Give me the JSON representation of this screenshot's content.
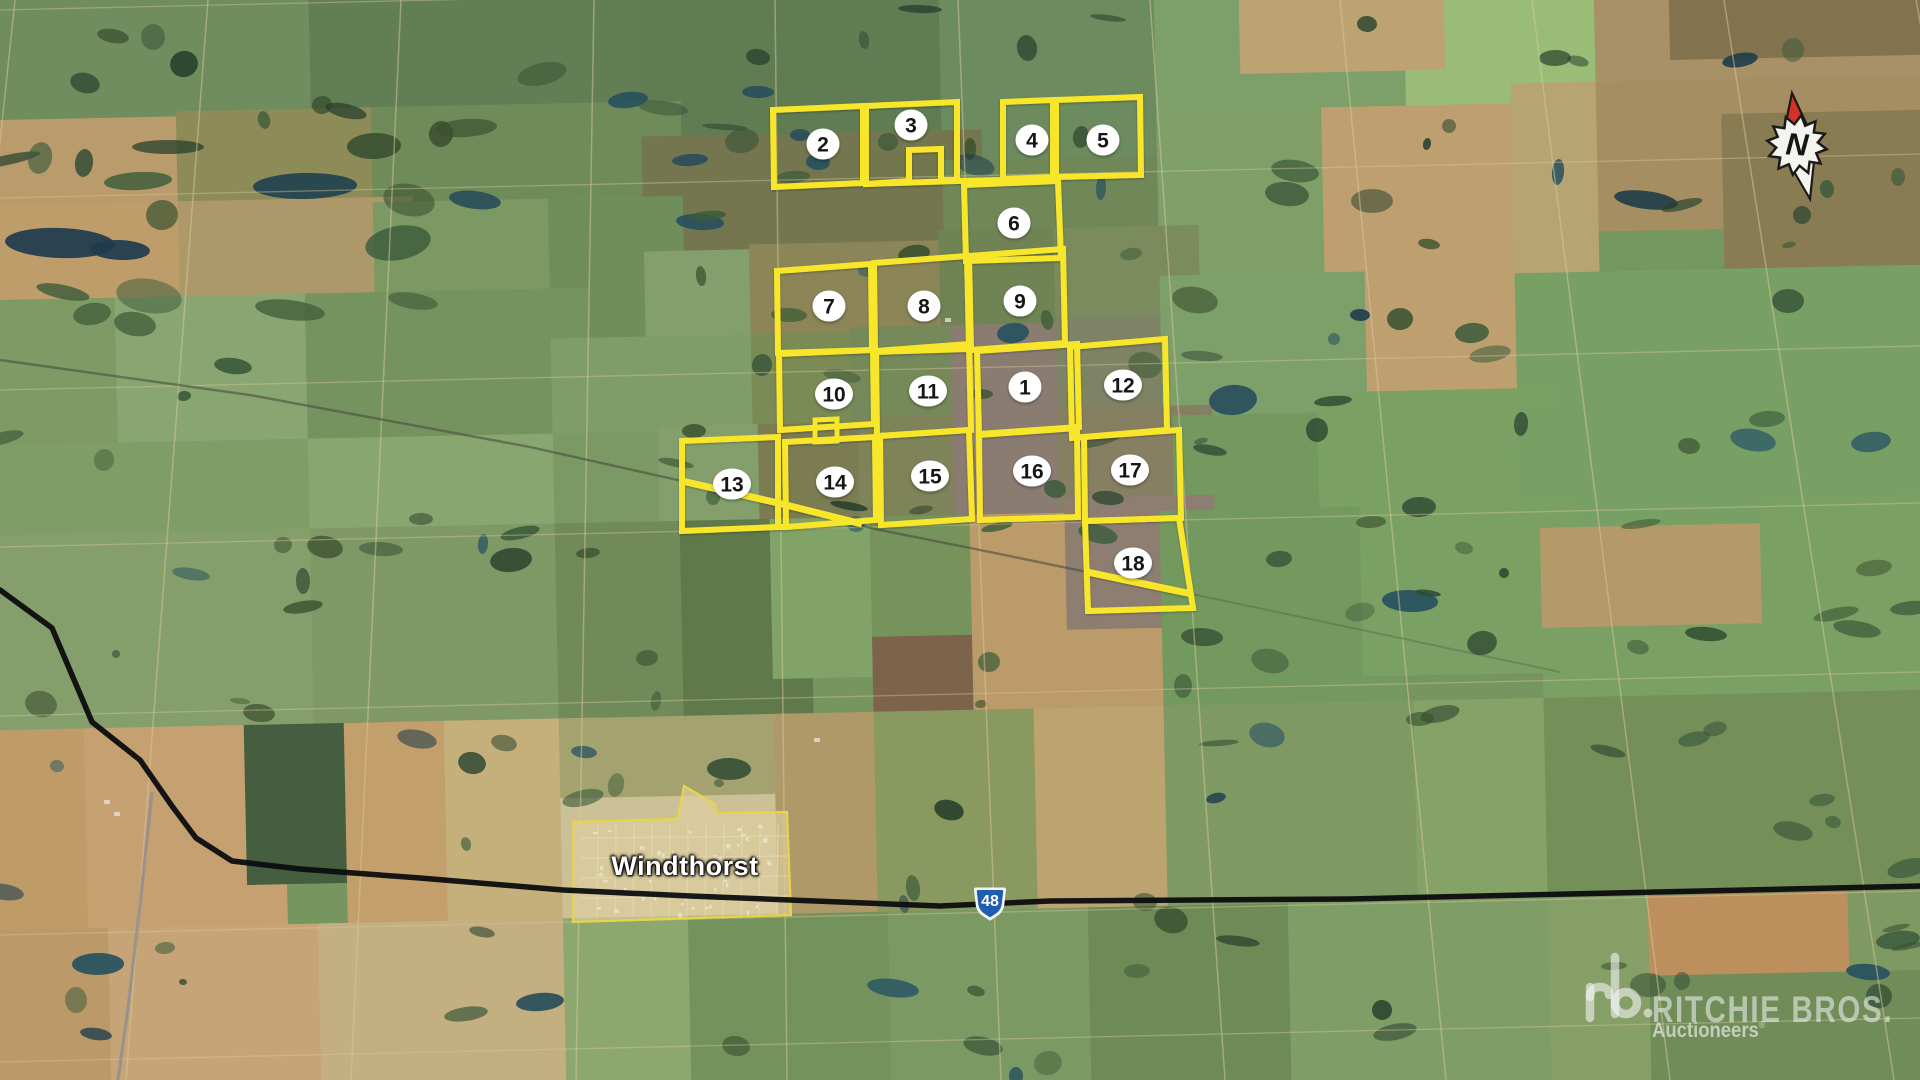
{
  "map": {
    "town": {
      "name": "Windthorst",
      "outline": [
        [
          573,
          822
        ],
        [
          678,
          819
        ],
        [
          684,
          786
        ],
        [
          715,
          804
        ],
        [
          716,
          813
        ],
        [
          787,
          812
        ],
        [
          791,
          915
        ],
        [
          573,
          922
        ]
      ]
    },
    "highway_shield": {
      "number": "48",
      "x": 990,
      "y": 905
    },
    "compass": {
      "label": "N"
    },
    "watermark": {
      "mark": "rb",
      "title": "RITCHIE BROS.",
      "tagline": "Auctioneers",
      "registered": "®"
    },
    "colors": {
      "parcel_outline": "#f8e62a",
      "marker_fill": "#ffffff",
      "marker_text": "#161616",
      "town_outline": "#e8d44c",
      "town_fill": "rgba(240,225,170,0.22)",
      "highway": "#0c0d0f",
      "shield_blue": "#1d5fae",
      "railway": "#43463a",
      "gray_road": "#8e8e8e",
      "section_road": "#dac89c"
    }
  },
  "parcels": [
    {
      "number": "1",
      "marker": [
        1025,
        387
      ],
      "outline": [
        [
          977,
          351
        ],
        [
          1077,
          344
        ],
        [
          1079,
          427
        ],
        [
          979,
          434
        ]
      ]
    },
    {
      "number": "2",
      "marker": [
        823,
        144
      ],
      "outline": [
        [
          773,
          110
        ],
        [
          863,
          106
        ],
        [
          863,
          183
        ],
        [
          774,
          187
        ]
      ]
    },
    {
      "number": "3",
      "marker": [
        911,
        125
      ],
      "outline": [
        [
          866,
          106
        ],
        [
          957,
          102
        ],
        [
          957,
          180
        ],
        [
          941,
          180
        ],
        [
          941,
          149
        ],
        [
          909,
          150
        ],
        [
          909,
          181
        ],
        [
          866,
          184
        ]
      ]
    },
    {
      "number": "4",
      "marker": [
        1032,
        140
      ],
      "outline": [
        [
          1003,
          102
        ],
        [
          1053,
          100
        ],
        [
          1053,
          177
        ],
        [
          1003,
          179
        ]
      ]
    },
    {
      "number": "5",
      "marker": [
        1103,
        140
      ],
      "outline": [
        [
          1056,
          100
        ],
        [
          1140,
          97
        ],
        [
          1141,
          175
        ],
        [
          1056,
          177
        ]
      ]
    },
    {
      "number": "6",
      "marker": [
        1014,
        223
      ],
      "outline": [
        [
          964,
          185
        ],
        [
          1058,
          181
        ],
        [
          1061,
          258
        ],
        [
          966,
          261
        ]
      ]
    },
    {
      "number": "7",
      "marker": [
        829,
        306
      ],
      "outline": [
        [
          777,
          271
        ],
        [
          871,
          264
        ],
        [
          872,
          350
        ],
        [
          778,
          353
        ]
      ]
    },
    {
      "number": "8",
      "marker": [
        924,
        306
      ],
      "outline": [
        [
          874,
          263
        ],
        [
          967,
          256
        ],
        [
          969,
          349
        ],
        [
          875,
          352
        ]
      ]
    },
    {
      "number": "9",
      "marker": [
        1020,
        301
      ],
      "outline": [
        [
          969,
          256
        ],
        [
          1063,
          249
        ],
        [
          1065,
          343
        ],
        [
          971,
          350
        ]
      ]
    },
    {
      "number": "10",
      "marker": [
        834,
        394
      ],
      "outline": [
        [
          779,
          354
        ],
        [
          873,
          350
        ],
        [
          874,
          424
        ],
        [
          780,
          430
        ]
      ]
    },
    {
      "number": "11",
      "marker": [
        928,
        391
      ],
      "outline": [
        [
          876,
          351
        ],
        [
          969,
          344
        ],
        [
          971,
          430
        ],
        [
          877,
          436
        ]
      ]
    },
    {
      "number": "12",
      "marker": [
        1123,
        385
      ],
      "outline": [
        [
          1070,
          347
        ],
        [
          1165,
          339
        ],
        [
          1167,
          430
        ],
        [
          1072,
          438
        ]
      ]
    },
    {
      "number": "13",
      "marker": [
        732,
        484
      ],
      "outline": [
        [
          682,
          441
        ],
        [
          778,
          437
        ],
        [
          778,
          527
        ],
        [
          682,
          531
        ]
      ]
    },
    {
      "number": "14",
      "marker": [
        835,
        482
      ],
      "outline": [
        [
          785,
          442
        ],
        [
          875,
          437
        ],
        [
          876,
          520
        ],
        [
          786,
          527
        ]
      ]
    },
    {
      "number": "15",
      "marker": [
        930,
        476
      ],
      "outline": [
        [
          880,
          436
        ],
        [
          969,
          430
        ],
        [
          972,
          519
        ],
        [
          881,
          525
        ]
      ]
    },
    {
      "number": "16",
      "marker": [
        1032,
        471
      ],
      "outline": [
        [
          979,
          435
        ],
        [
          1077,
          428
        ],
        [
          1078,
          517
        ],
        [
          980,
          520
        ]
      ]
    },
    {
      "number": "17",
      "marker": [
        1130,
        470
      ],
      "outline": [
        [
          1084,
          437
        ],
        [
          1179,
          430
        ],
        [
          1181,
          518
        ],
        [
          1085,
          521
        ]
      ]
    },
    {
      "number": "18",
      "marker": [
        1133,
        563
      ],
      "outline": [
        [
          1085,
          521
        ],
        [
          1179,
          518
        ],
        [
          1193,
          608
        ],
        [
          1088,
          611
        ]
      ]
    }
  ],
  "overlay_extras": {
    "yard_notch": [
      [
        815,
        420
      ],
      [
        837,
        419
      ],
      [
        837,
        441
      ],
      [
        815,
        442
      ]
    ],
    "connectors": [
      [
        [
          866,
          184
        ],
        [
          957,
          181
        ],
        [
          1003,
          180
        ],
        [
          1053,
          178
        ],
        [
          1058,
          181
        ]
      ],
      [
        [
          778,
          527
        ],
        [
          786,
          527
        ]
      ]
    ],
    "diagonal_13_14": [
      [
        682,
        481
      ],
      [
        778,
        503
      ],
      [
        862,
        524
      ]
    ],
    "diagonal_18": [
      [
        1087,
        572
      ],
      [
        1192,
        594
      ]
    ]
  },
  "routes": {
    "highway": [
      [
        0,
        590
      ],
      [
        52,
        628
      ],
      [
        92,
        722
      ],
      [
        140,
        760
      ],
      [
        172,
        806
      ],
      [
        196,
        838
      ],
      [
        232,
        861
      ],
      [
        300,
        869
      ],
      [
        420,
        878
      ],
      [
        563,
        890
      ],
      [
        690,
        896
      ],
      [
        940,
        906
      ],
      [
        1050,
        901
      ],
      [
        1350,
        899
      ],
      [
        1920,
        886
      ]
    ],
    "railway_main": [
      [
        0,
        360
      ],
      [
        250,
        395
      ],
      [
        530,
        447
      ],
      [
        682,
        481
      ],
      [
        778,
        504
      ],
      [
        875,
        529
      ],
      [
        990,
        552
      ],
      [
        1087,
        572
      ],
      [
        1192,
        594
      ]
    ],
    "railway_tail": [
      [
        1192,
        594
      ],
      [
        1560,
        672
      ]
    ],
    "gray_road": [
      [
        152,
        792
      ],
      [
        140,
        905
      ],
      [
        128,
        1008
      ],
      [
        118,
        1080
      ]
    ]
  }
}
